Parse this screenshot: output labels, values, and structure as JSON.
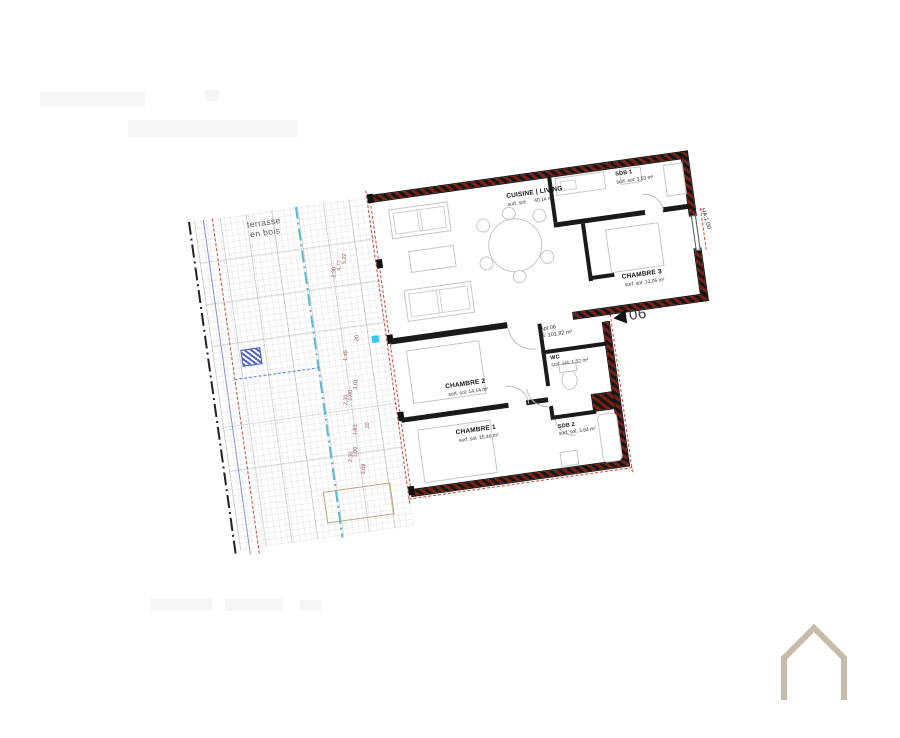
{
  "apartment": {
    "id_line": "Apt 06",
    "surface_line": "S: 101,82 m²",
    "marker_number": "06",
    "wall_note": "HA:1,00"
  },
  "rooms": {
    "cuisine_living": {
      "name": "CUISINE | LIVING",
      "surf_label": "surf. sol:",
      "surf_value": "40,14 m²"
    },
    "sdb1": {
      "name": "SDB 1",
      "surf_label": "surf. sol:",
      "surf_value": "3,53 m²"
    },
    "chambre3": {
      "name": "CHAMBRE 3",
      "surf_label": "surf. sol:",
      "surf_value": "13,05 m²"
    },
    "chambre2": {
      "name": "CHAMBRE 2",
      "surf_label": "surf. sol:",
      "surf_value": "14,14 m²"
    },
    "chambre1": {
      "name": "CHAMBRE 1",
      "surf_label": "surf. sol:",
      "surf_value": "15,46 m²"
    },
    "wc": {
      "name": "WC",
      "surf_label": "surf. sol:",
      "surf_value": "1,52 m²"
    },
    "sdb2": {
      "name": "SDB 2",
      "surf_label": "surf. sol:",
      "surf_value": "3,84 m²"
    }
  },
  "terrace": {
    "label_line1": "terrasse",
    "label_line2": "en bois",
    "dims": [
      "5,22",
      "4,77",
      "2,30",
      "20",
      "1,45",
      "3,01",
      "1,00",
      "2,30",
      "10",
      "1,81",
      "1,00",
      "2,30",
      "3,09"
    ]
  },
  "colors": {
    "wall_hatch_red": "#7c2014",
    "dashed_red": "#c84a3a",
    "axis_blue": "#58b9d8",
    "planter_blue": "#3d56c0",
    "cyan_marker": "#37c9e9",
    "logo_beige": "#c7bca9"
  }
}
